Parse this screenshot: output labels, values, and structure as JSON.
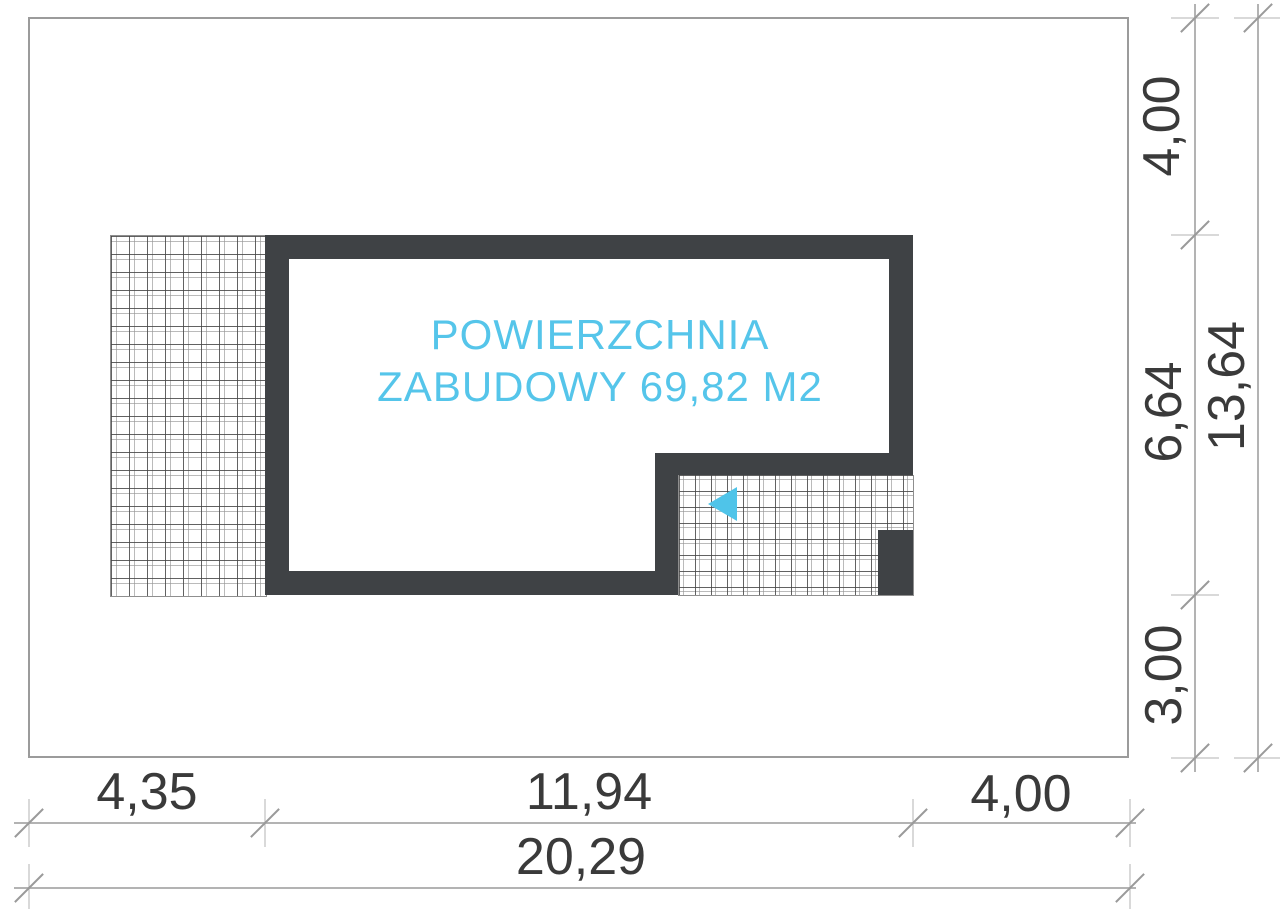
{
  "plan": {
    "area_label": {
      "line1": "POWIERZCHNIA",
      "line2": "ZABUDOWY 69,82 M2"
    }
  },
  "dimensions": {
    "bottom": {
      "seg1": "4,35",
      "seg2": "11,94",
      "seg3": "4,00",
      "total": "20,29"
    },
    "right": {
      "seg1": "4,00",
      "seg2": "6,64",
      "seg3": "3,00",
      "total": "13,64"
    }
  },
  "colors": {
    "accent_cyan": "#55c5ea",
    "arrow_cyan": "#4fc4e9",
    "wall_dark": "#3f4245",
    "dimension_text": "#3a3a3a",
    "dimension_line": "#b3b3b3",
    "plot_border": "#9b9b9b"
  }
}
